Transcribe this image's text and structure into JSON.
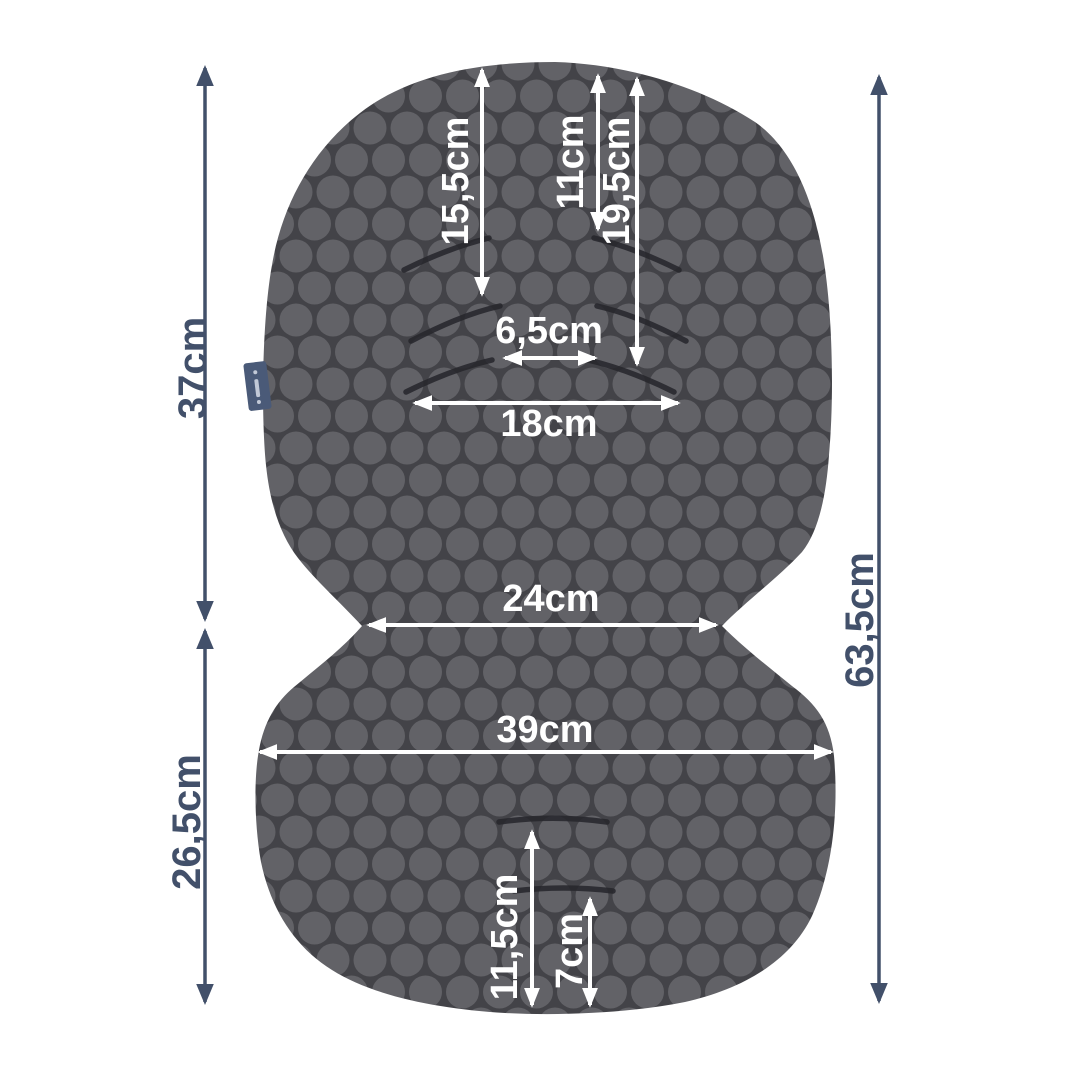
{
  "diagram": {
    "colors": {
      "background": "#ffffff",
      "pad_base": "#434348",
      "pad_dot": "#626267",
      "pad_slit": "#26262b",
      "arrow_on_pad": "#ffffff",
      "arrow_outside": "#42506a",
      "brand_tag": "#4a5a78"
    },
    "measurements": {
      "upper_slot_row1_height": "15,5cm",
      "upper_slot_row1_right_height": "11cm",
      "upper_slot_row3_height": "19,5cm",
      "slot_inner_gap": "6,5cm",
      "slot_outer_width": "18cm",
      "backrest_height": "37cm",
      "waist_width": "24cm",
      "overall_height": "63,5cm",
      "seat_width": "39cm",
      "seat_height": "26,5cm",
      "bottom_slot_upper_offset": "11,5cm",
      "bottom_slot_lower_offset": "7cm"
    }
  }
}
